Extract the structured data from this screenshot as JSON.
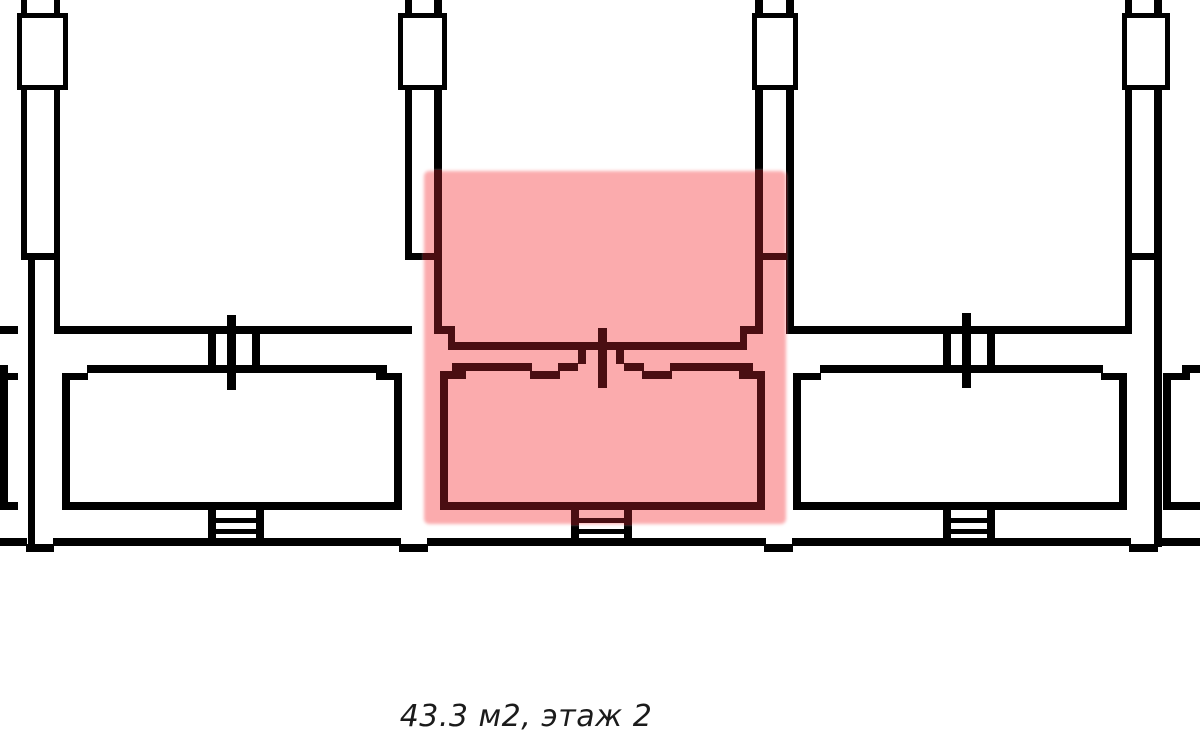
{
  "caption": {
    "text": "43.3 м2, этаж 2",
    "area_m2": "43.3",
    "floor": "2"
  },
  "highlight": {
    "name": "selected-apartment",
    "status": "highlighted"
  },
  "colors": {
    "background": "#ffffff",
    "walls": "#000000",
    "highlight_fill": "#fbabad",
    "highlighted_walls": "#4a0e12",
    "caption_text": "#1b1b1b"
  }
}
